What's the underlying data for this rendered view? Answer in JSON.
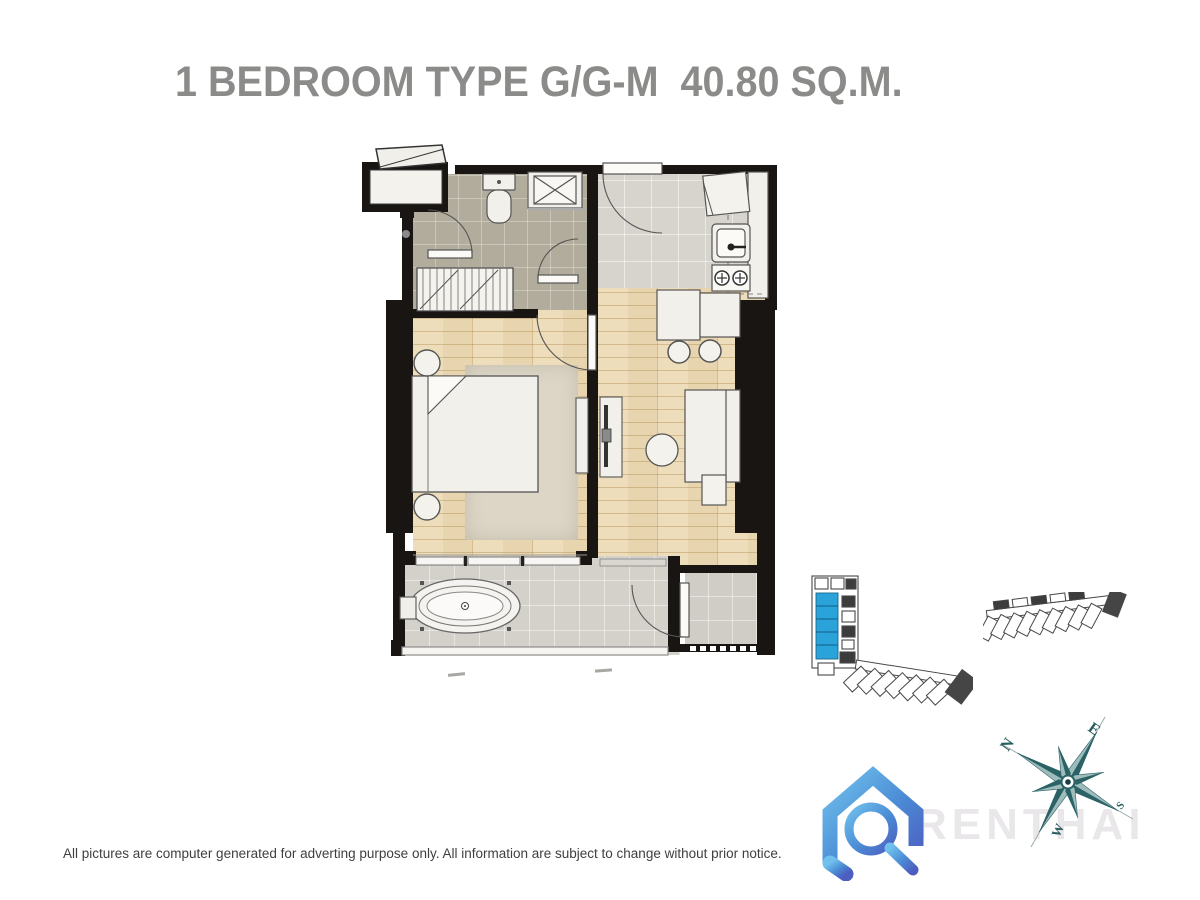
{
  "page": {
    "title": "1 BEDROOM TYPE G/G-M  40.80 SQ.M.",
    "disclaimer": "All pictures are computer generated for adverting purpose only. All information are subject to change without prior notice."
  },
  "watermark": {
    "brand_text": "RENTHAI"
  },
  "compass": {
    "north": "N",
    "east": "E",
    "south": "S",
    "west": "W"
  },
  "floorplan": {
    "rooms": [
      "bedroom",
      "living-dining",
      "kitchen",
      "bathroom",
      "wardrobe-corridor",
      "balcony-with-bathtub",
      "ac-ledge",
      "entrance-alcove"
    ]
  },
  "colors": {
    "title_gray": "#8b8b89",
    "wall_black": "#181512",
    "wood_floor": "#ecd9b2",
    "bathroom_tile": "#b2ac9c",
    "kitchen_tile": "#d7d3cd",
    "balcony_tile": "#d4d1cb",
    "keyplan_highlight_blue": "#2aa3da",
    "compass_teal": "#2a6266",
    "logo_blue_light": "#6fc0ec",
    "logo_blue_dark": "#4c5fc0",
    "watermark_gray": "#e9e7ea"
  }
}
